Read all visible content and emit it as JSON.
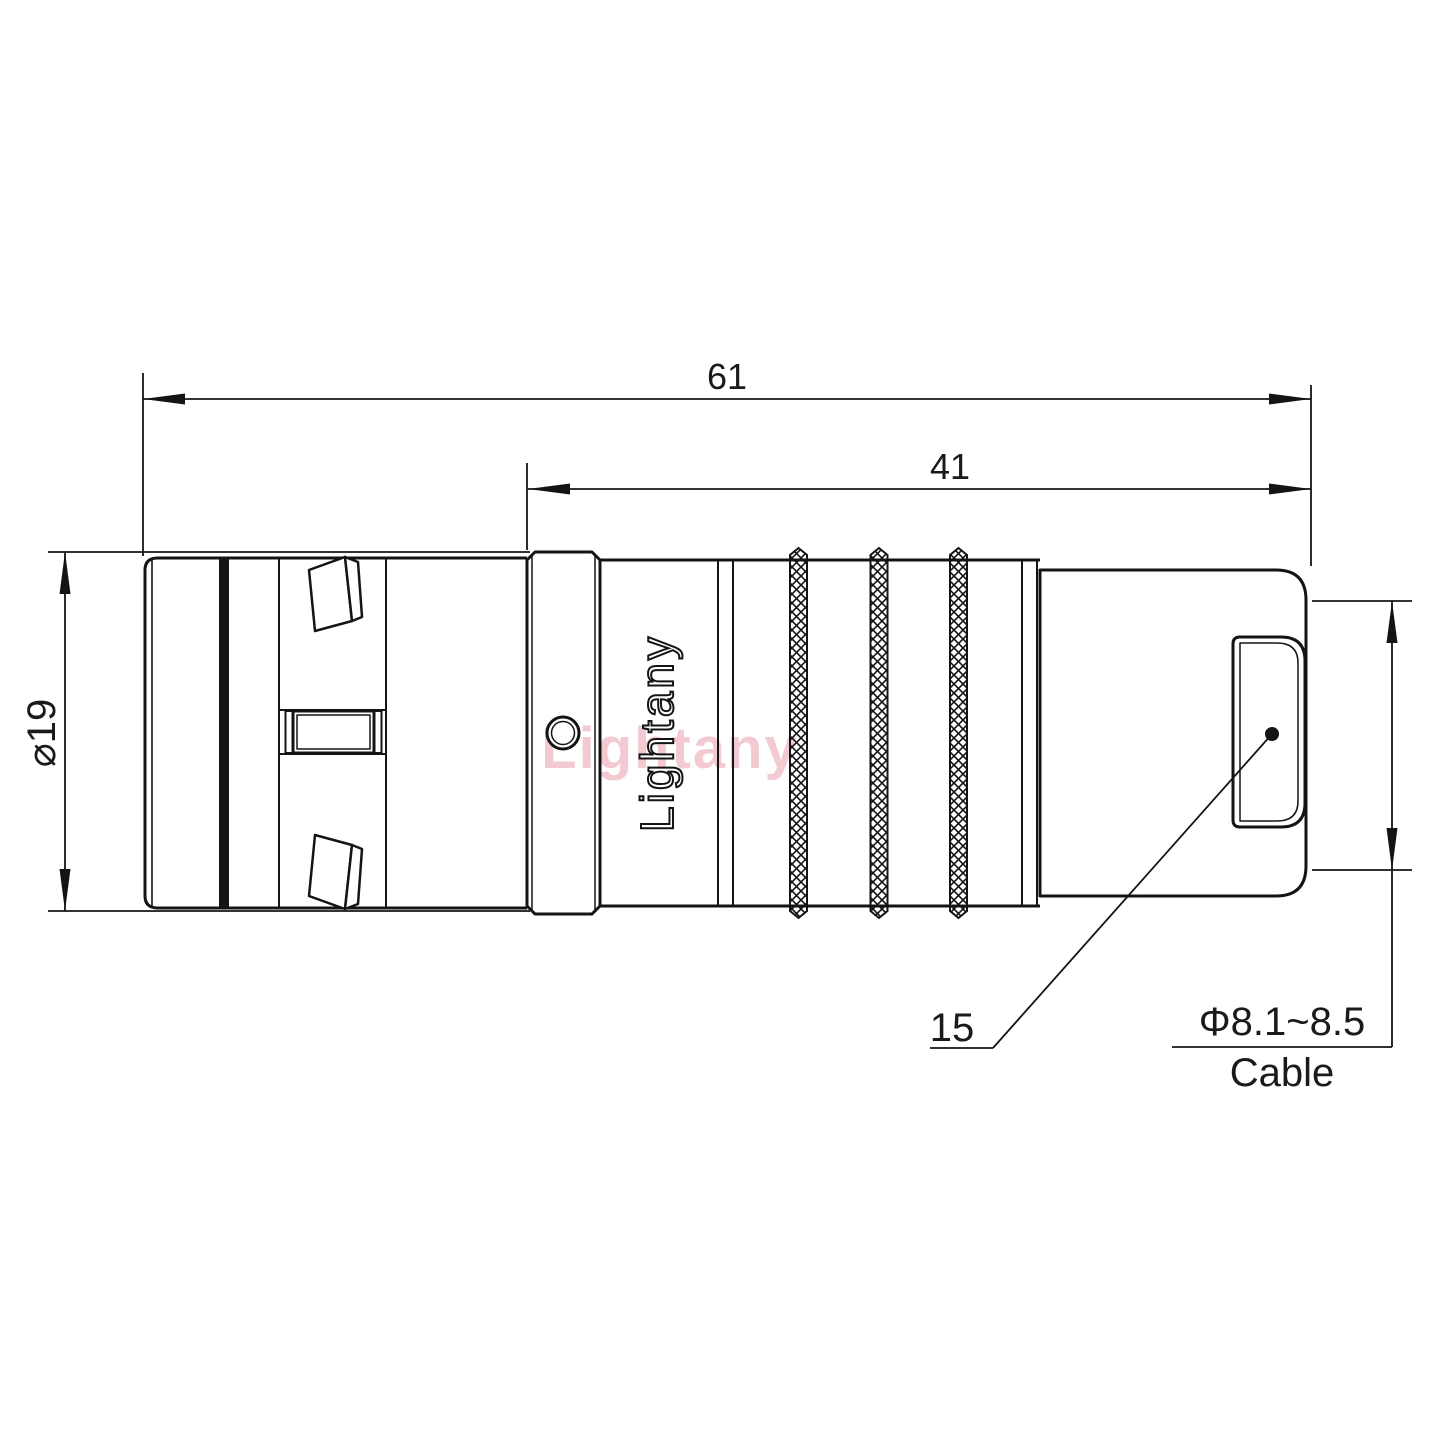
{
  "drawing": {
    "title": "Push-pull circular connector side view technical drawing",
    "watermark": {
      "text": "Lightany",
      "color": "#dd6078"
    },
    "engraving": {
      "text": "Lightany"
    },
    "dimensions": {
      "overall_length": "61",
      "rear_length": "41",
      "front_diameter": "⌀19",
      "boot_length": "15",
      "cable_diameter_range": "Φ8.1~8.5",
      "cable_label": "Cable"
    },
    "colors": {
      "line": "#141414",
      "background": "#ffffff"
    }
  }
}
